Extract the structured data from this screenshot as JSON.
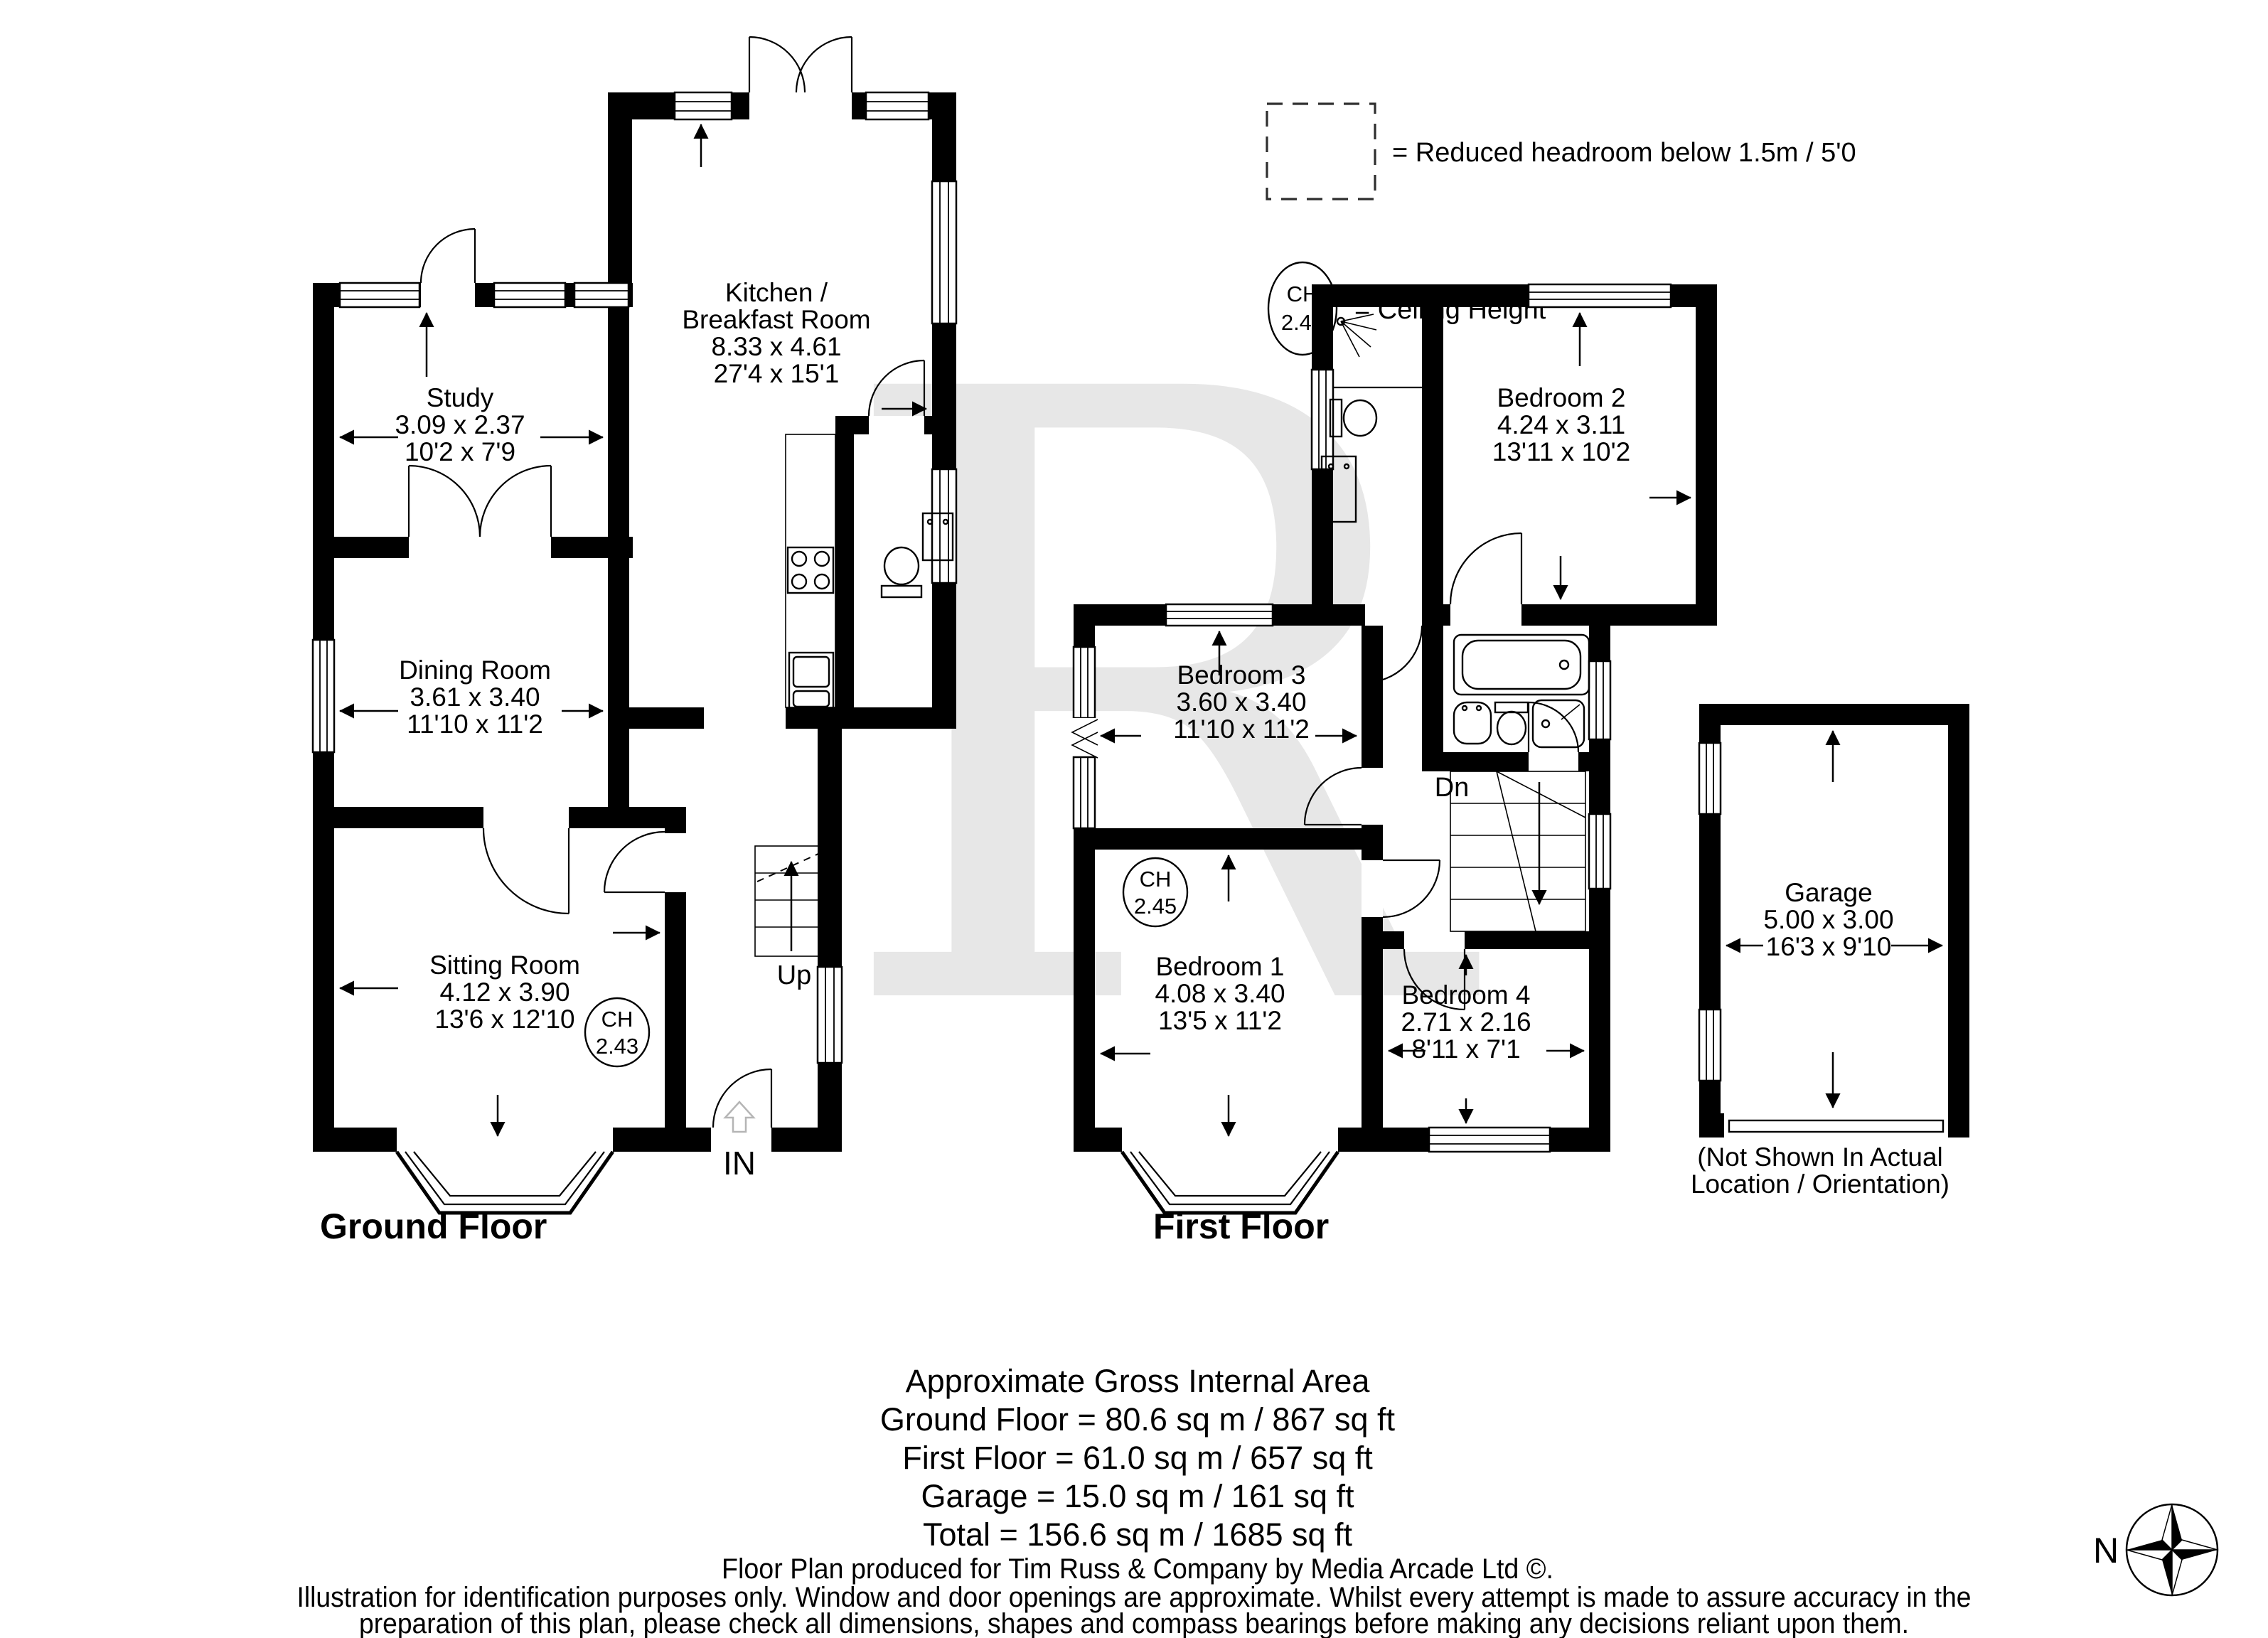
{
  "watermark": {
    "letter": "R"
  },
  "legend": {
    "reduced_headroom": "= Reduced headroom below 1.5m / 5'0",
    "ceiling_height": "= Ceiling Height",
    "ch_abbr": "CH",
    "ch_value": "2.43"
  },
  "floors": {
    "ground": {
      "title": "Ground Floor"
    },
    "first": {
      "title": "First Floor"
    }
  },
  "rooms": {
    "study": {
      "name": "Study",
      "metric": "3.09 x 2.37",
      "imperial": "10'2 x 7'9"
    },
    "kitchen": {
      "name_line1": "Kitchen /",
      "name_line2": "Breakfast Room",
      "metric": "8.33 x 4.61",
      "imperial": "27'4 x 15'1"
    },
    "dining": {
      "name": "Dining Room",
      "metric": "3.61 x 3.40",
      "imperial": "11'10 x 11'2"
    },
    "sitting": {
      "name": "Sitting Room",
      "metric": "4.12 x 3.90",
      "imperial": "13'6 x 12'10",
      "ch_abbr": "CH",
      "ch_value": "2.43"
    },
    "bedroom1": {
      "name": "Bedroom 1",
      "metric": "4.08 x 3.40",
      "imperial": "13'5 x 11'2",
      "ch_abbr": "CH",
      "ch_value": "2.45"
    },
    "bedroom2": {
      "name": "Bedroom 2",
      "metric": "4.24 x 3.11",
      "imperial": "13'11 x 10'2"
    },
    "bedroom3": {
      "name": "Bedroom 3",
      "metric": "3.60 x 3.40",
      "imperial": "11'10 x 11'2"
    },
    "bedroom4": {
      "name": "Bedroom 4",
      "metric": "2.71 x 2.16",
      "imperial": "8'11 x 7'1"
    },
    "garage": {
      "name": "Garage",
      "metric": "5.00 x 3.00",
      "imperial": "16'3 x 9'10",
      "note_line1": "(Not Shown In Actual",
      "note_line2": "Location / Orientation)"
    }
  },
  "annotations": {
    "up": "Up",
    "down": "Dn",
    "entrance": "IN",
    "north": "N"
  },
  "footer": {
    "area_title": "Approximate Gross Internal Area",
    "area_ground": "Ground Floor = 80.6 sq m / 867 sq ft",
    "area_first": "First Floor = 61.0 sq m / 657 sq ft",
    "area_garage": "Garage = 15.0 sq m / 161 sq ft",
    "area_total": "Total = 156.6 sq m / 1685 sq ft",
    "produced_by": "Floor Plan produced for Tim Russ & Company by Media Arcade Ltd ©.",
    "disclaimer_line1": "Illustration for identification purposes only. Window and door openings are approximate. Whilst every attempt is made to assure accuracy in the",
    "disclaimer_line2": "preparation of this plan, please check all dimensions, shapes and compass bearings before making any decisions reliant upon them."
  },
  "colors": {
    "walls": "#000000",
    "watermark": "#e7e7e7",
    "background": "#ffffff"
  }
}
